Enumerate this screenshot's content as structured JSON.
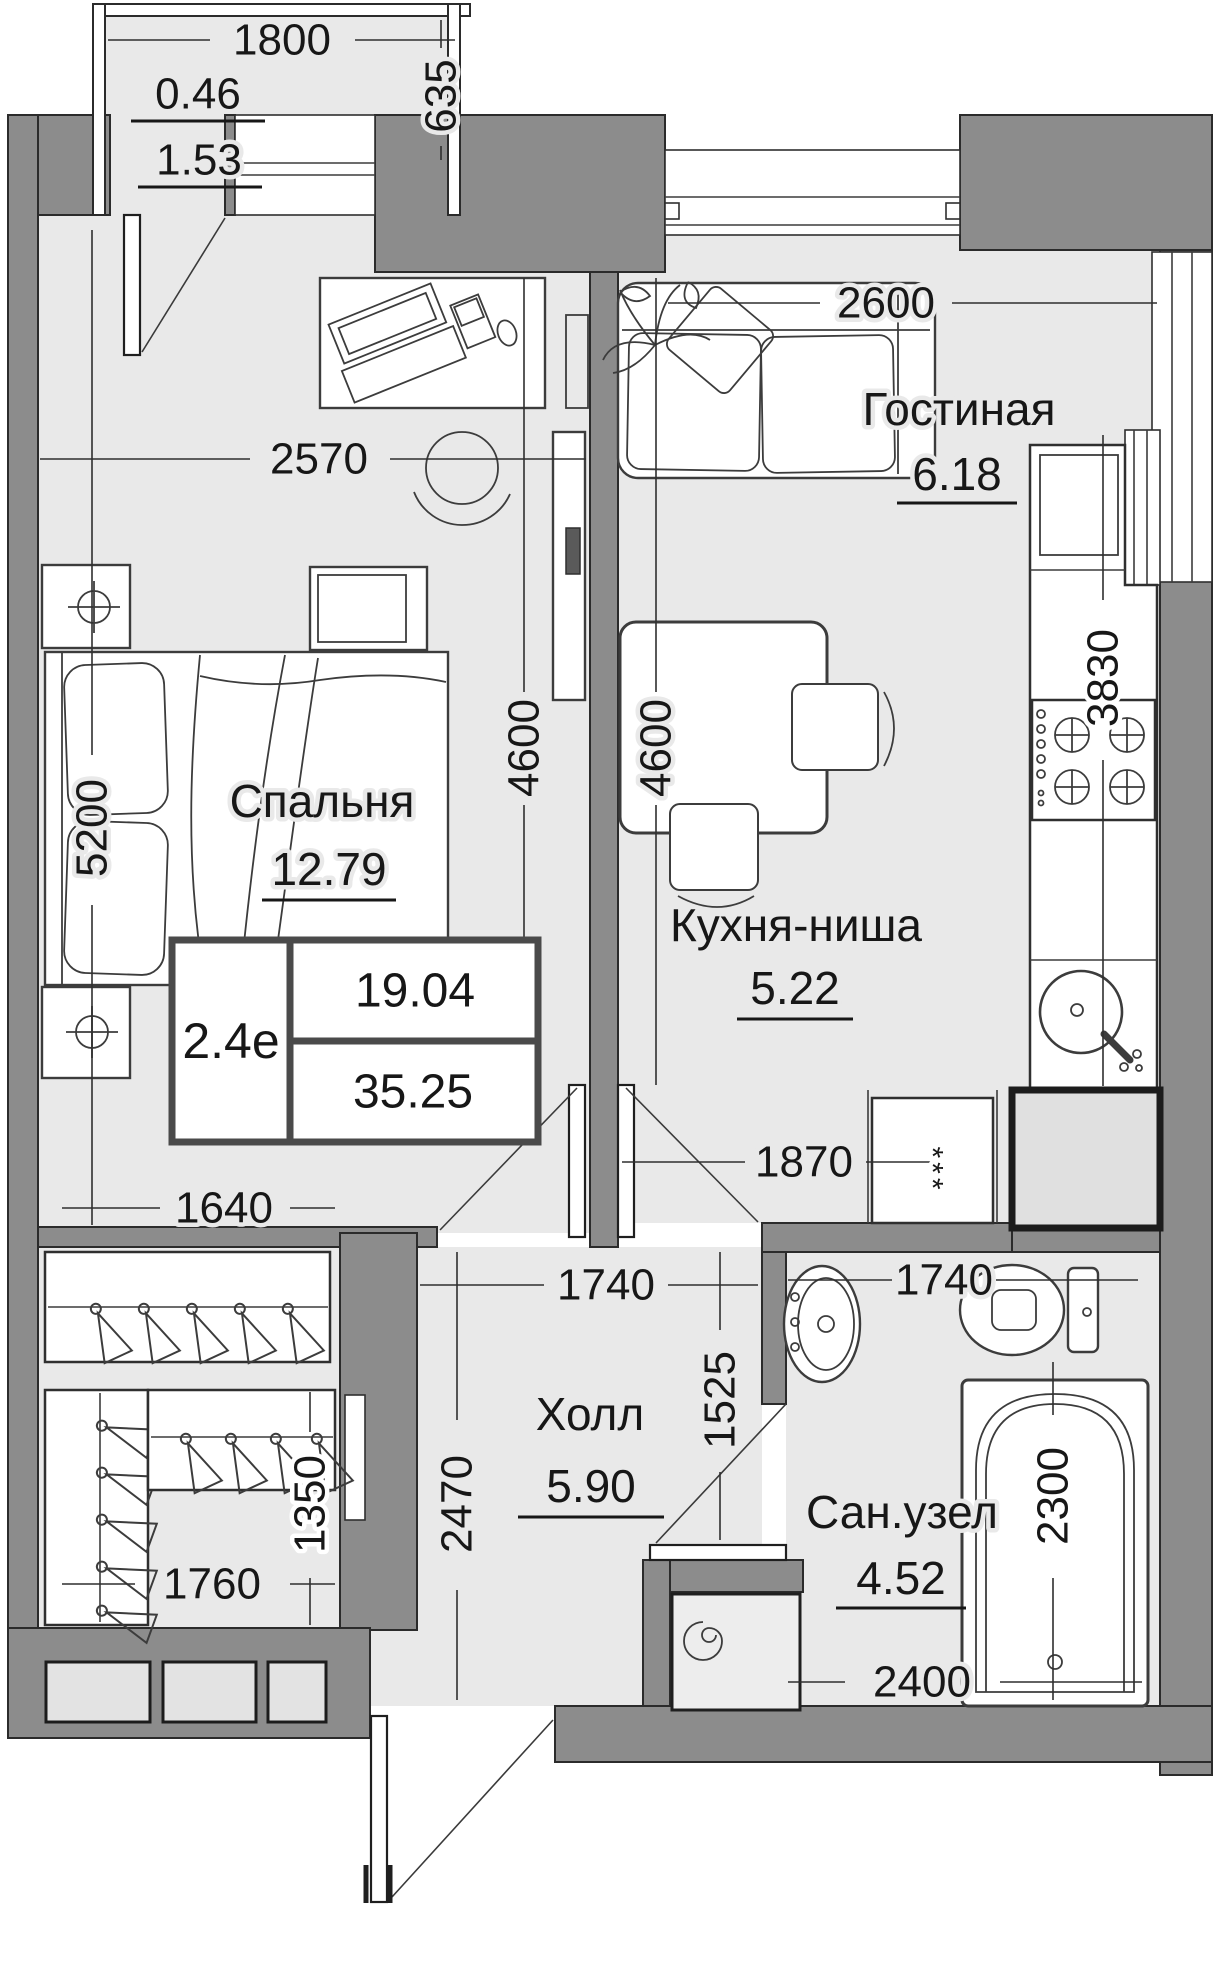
{
  "unit": {
    "type": "2.4е",
    "living_area": "19.04",
    "total_area": "35.25"
  },
  "rooms": {
    "living": {
      "name": "Гостиная",
      "area": "6.18"
    },
    "bedroom": {
      "name": "Спальня",
      "area": "12.79"
    },
    "kitchen": {
      "name": "Кухня-ниша",
      "area": "5.22"
    },
    "hall": {
      "name": "Холл",
      "area": "5.90"
    },
    "bath": {
      "name": "Сан.узел",
      "area": "4.52"
    },
    "balcony": {
      "area_reduced": "0.46",
      "area_full": "1.53"
    }
  },
  "dims": {
    "balcony_w": "1800",
    "balcony_d": "635",
    "bedroom_w": "2570",
    "bedroom_h": "5200",
    "bedroom_partition_h": "4600",
    "kitchen_h": "4600",
    "living_w": "2600",
    "counter_run": "3830",
    "kitchen_w": "1870",
    "wardrobe_w": "1640",
    "hall_w": "1740",
    "bath_w": "1740",
    "hall_h": "2470",
    "hall_pass": "1525",
    "tub_l": "2300",
    "closet_d": "1350",
    "closet_w": "1760",
    "bath_bottom": "2400"
  },
  "marks": {
    "vent": "***"
  },
  "colors": {
    "floor": "#e9e9e9",
    "wall": "#8c8c8c",
    "line": "#2f2f2f"
  }
}
